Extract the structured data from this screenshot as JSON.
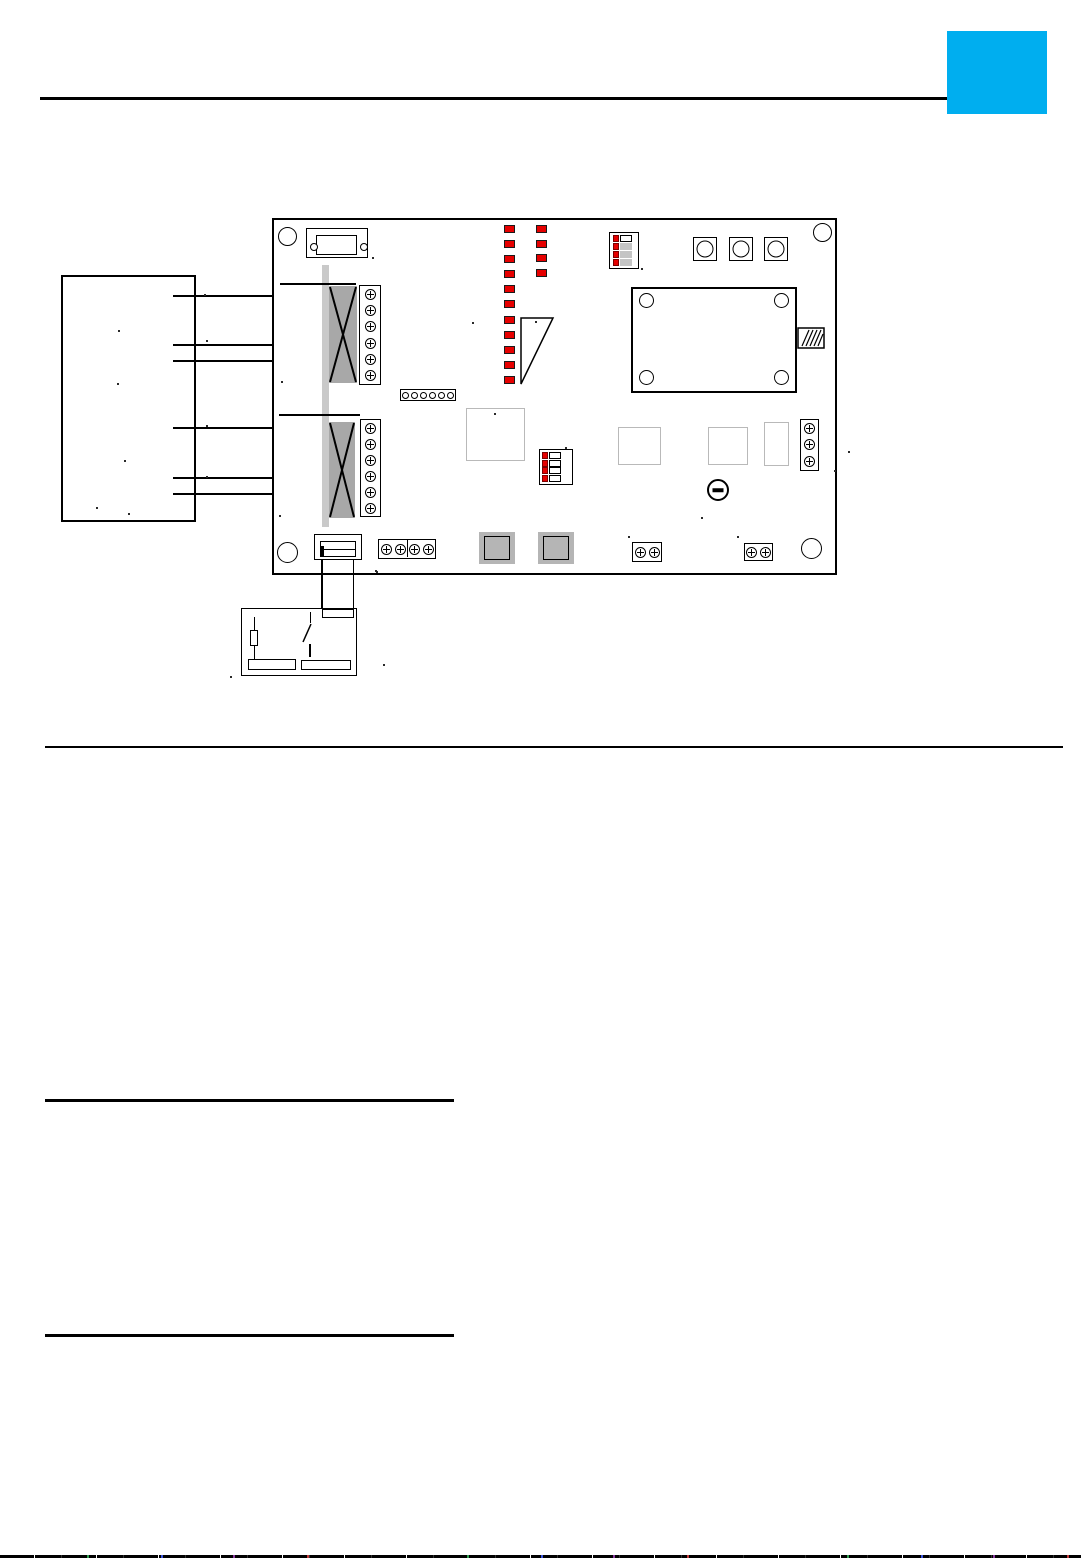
{
  "colors": {
    "accent_blue": "#00AEEF",
    "led_red": "#e60000",
    "transformer_gray": "#a8a8a8",
    "cable_gray": "#c9c9c9",
    "slider_gray": "#c4c4c4",
    "relay_gray": "#b5b5b5",
    "faint_border": "#b9b9b9",
    "line_black": "#000000"
  },
  "figure": {
    "kind": "pcb-wiring-diagram",
    "leds": {
      "col1": 11,
      "col2": 4
    },
    "screws": {
      "t1": 6,
      "t2": 6,
      "t3": 3,
      "t4": 4,
      "p1": 2,
      "p2": 2
    },
    "conn6": 6,
    "buttons": 3,
    "transformers": 2,
    "mounting_holes": 4,
    "dip_top": {
      "rows": [
        {
          "switch_color": "#e60000",
          "toggle_color": "#ffffff",
          "toggle_border": true
        },
        {
          "switch_color": "#e60000",
          "toggle_color": "#c4c4c4",
          "toggle_border": false
        },
        {
          "switch_color": "#e60000",
          "toggle_color": "#c4c4c4",
          "toggle_border": false
        },
        {
          "switch_color": "#e60000",
          "toggle_color": "#c4c4c4",
          "toggle_border": false
        }
      ]
    },
    "dip_mid": {
      "rows": [
        {
          "switch_color": "#e60000",
          "toggle_color": "#ffffff",
          "toggle_border": true
        },
        {
          "switch_color": "#e60000",
          "toggle_color": "#ffffff",
          "toggle_border": true
        },
        {
          "switch_color": "#e60000",
          "toggle_color": "#ffffff",
          "toggle_border": true
        },
        {
          "switch_color": "#e60000",
          "toggle_color": "#ffffff",
          "toggle_border": true
        }
      ]
    }
  },
  "specks": [
    [
      204,
      294
    ],
    [
      206,
      340
    ],
    [
      206,
      425
    ],
    [
      206,
      476
    ],
    [
      118,
      330
    ],
    [
      117,
      383
    ],
    [
      124,
      460
    ],
    [
      96,
      507
    ],
    [
      128,
      513
    ],
    [
      281,
      381
    ],
    [
      279,
      515
    ],
    [
      372,
      257
    ],
    [
      641,
      268
    ],
    [
      565,
      447
    ],
    [
      375,
      570
    ],
    [
      472,
      322
    ],
    [
      535,
      321
    ],
    [
      494,
      413
    ],
    [
      628,
      536
    ],
    [
      737,
      536
    ],
    [
      701,
      517
    ],
    [
      834,
      470
    ],
    [
      848,
      451
    ],
    [
      383,
      664
    ],
    [
      230,
      676
    ],
    [
      376,
      571
    ]
  ]
}
